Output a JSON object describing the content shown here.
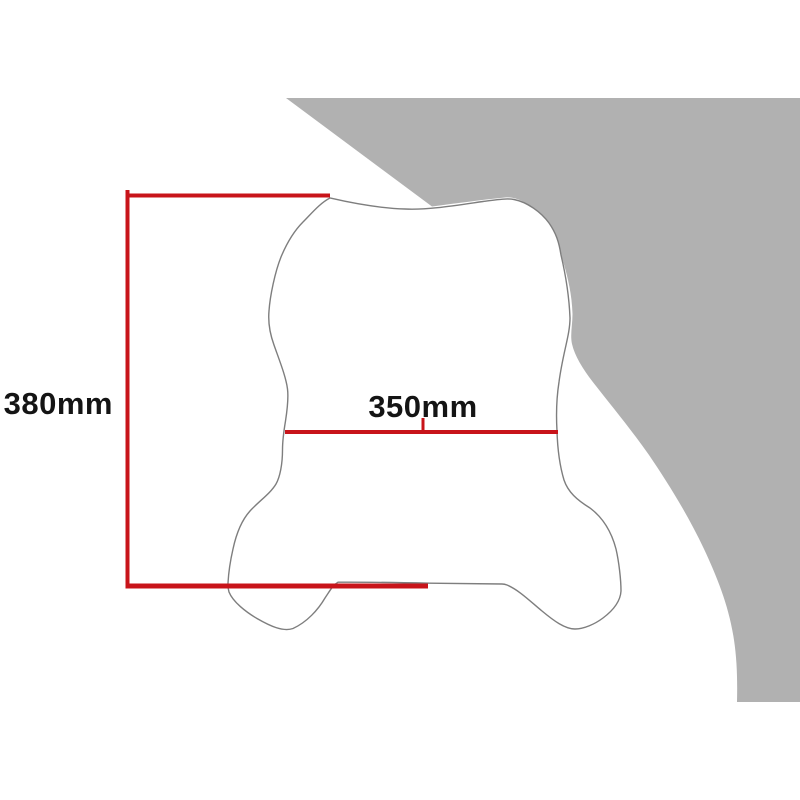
{
  "diagram": {
    "title": "Windscreen dimension diagram",
    "dimensions": {
      "height": {
        "label": "380mm"
      },
      "width": {
        "label": "350mm"
      }
    }
  },
  "colors": {
    "background": "#ffffff",
    "swoosh": "#b1b1b1",
    "outline": "#7e7e7e",
    "dimension": "#c8141a",
    "text": "#141414"
  }
}
